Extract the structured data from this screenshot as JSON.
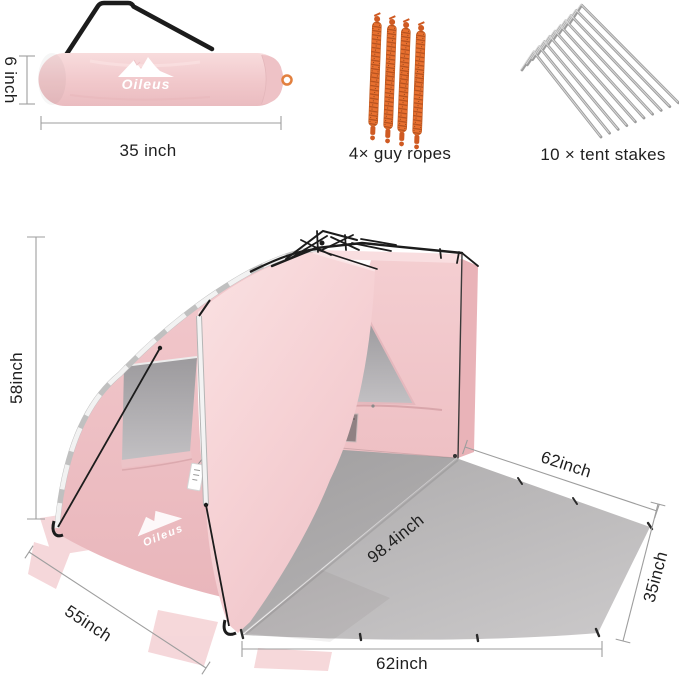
{
  "brand": "Oileus",
  "top_row": {
    "bag": {
      "logo_text": "Oileus",
      "height_label": "6 inch",
      "length_label": "35 inch"
    },
    "guy_ropes": {
      "caption": "4× guy ropes",
      "count": 4
    },
    "tent_stakes": {
      "caption": "10 × tent stakes",
      "count": 10
    }
  },
  "tent": {
    "logo_text": "Oileus",
    "dimensions": {
      "height": "58inch",
      "front_edge": "55inch",
      "mat_top_edge": "62inch",
      "mat_diagonal": "98.4inch",
      "mat_right_edge": "35inch",
      "mat_bottom_edge": "62inch"
    }
  },
  "colors": {
    "tent_pink": "#f5d0d3",
    "tent_pink_dark": "#eab9bd",
    "mat_gray": "#b6b4b5",
    "rope_orange": "#e8702f",
    "stake_gray": "#9d9d9d",
    "frame_black": "#1c1c1c",
    "dim_line_gray": "#9e9e9e",
    "label_text": "#1f1f1f"
  }
}
